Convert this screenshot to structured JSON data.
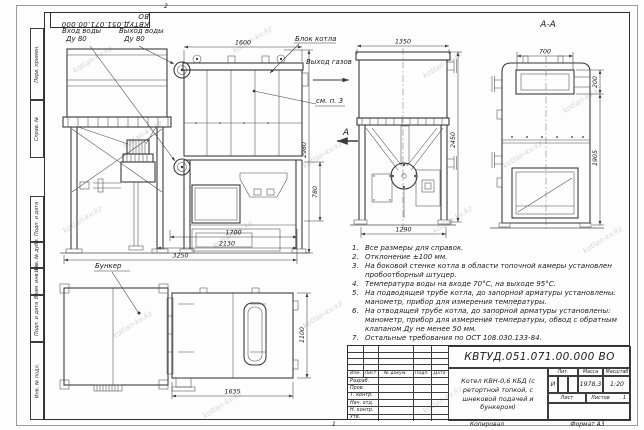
{
  "top_stamp": {
    "doc_number": "КВТУД.051.071.00.000 ВО"
  },
  "frame": {
    "fold_mark_top": "2",
    "fold_mark_bottom": "1"
  },
  "side_panel": {
    "items": [
      "Перв. примен.",
      "Справ. №",
      "Подп. и дата",
      "Инв. № дубл.",
      "Взам. инв. №",
      "Подп. и дата",
      "Инв. № подл."
    ]
  },
  "labels": {
    "water_inlet": "Вход воды",
    "water_inlet_dn": "Ду 80",
    "water_outlet": "Выход воды",
    "water_outlet_dn": "Ду 80",
    "boiler_block": "Блок котла",
    "gas_outlet": "Выход газов",
    "see_note": "см. п. 3",
    "view_arrow": "А",
    "section_title": "А-А",
    "bunker": "Бункер"
  },
  "dimensions": {
    "front_width": "1600",
    "front_height": "2980",
    "firebox_height": "780",
    "length_1700": "1700",
    "length_2130": "2130",
    "length_3250": "3250",
    "side_width": "1350",
    "side_height": "2450",
    "side_base": "1290",
    "section_width": "700",
    "section_top_offset": "200",
    "section_height": "1905",
    "plan_depth": "1100",
    "plan_length": "1635"
  },
  "notes": {
    "items": [
      {
        "n": "1.",
        "text": "Все размеры для справок."
      },
      {
        "n": "2.",
        "text": "Отклонение ±100 мм."
      },
      {
        "n": "3.",
        "text": "На боковой стенке котла в области топочной камеры установлен пробоотборный штуцер."
      },
      {
        "n": "4.",
        "text": "Температура воды на входе 70°С, на выходе 95°С."
      },
      {
        "n": "5.",
        "text": "На подводящей трубе котла, до запорной арматуры установлены: манометр, прибор для измерения температуры."
      },
      {
        "n": "6.",
        "text": "На отводящей трубе котла, до запорной арматуры установлены: манометр, прибор для измерения температуры, обвод с обратным клапаном Ду не менее 50 мм."
      },
      {
        "n": "7.",
        "text": "Остальные требования по ОСТ 108.030.133-84."
      }
    ]
  },
  "title_block": {
    "doc_number": "КВТУД.051.071.00.000 ВО",
    "name": "Котел КВН-0,6 КБД (с\nретортной топкой, с\nшнековой подачей и бункером)",
    "col_izm": "Изм.",
    "col_list": "Лист",
    "col_doc": "№ докум.",
    "col_podp": "Подп.",
    "col_data": "Дата",
    "row_razrab": "Разраб.",
    "row_prov": "Пров.",
    "row_tkontr": "Т. контр.",
    "row_nachotd": "Нач. отд.",
    "row_nkontr": "Н. контр.",
    "row_utv": "Утв.",
    "lit_label": "Лит.",
    "lit_value": "И",
    "mass_label": "Масса",
    "mass_value": "1978,3",
    "scale_label": "Масштаб",
    "scale_value": "1:20",
    "list_label": "Лист",
    "listov_label": "Листов",
    "listov_value": "1",
    "copy_label": "Копировал",
    "format_label": "Формат А3"
  },
  "watermark": {
    "text": "kotlan-kv.kz"
  }
}
